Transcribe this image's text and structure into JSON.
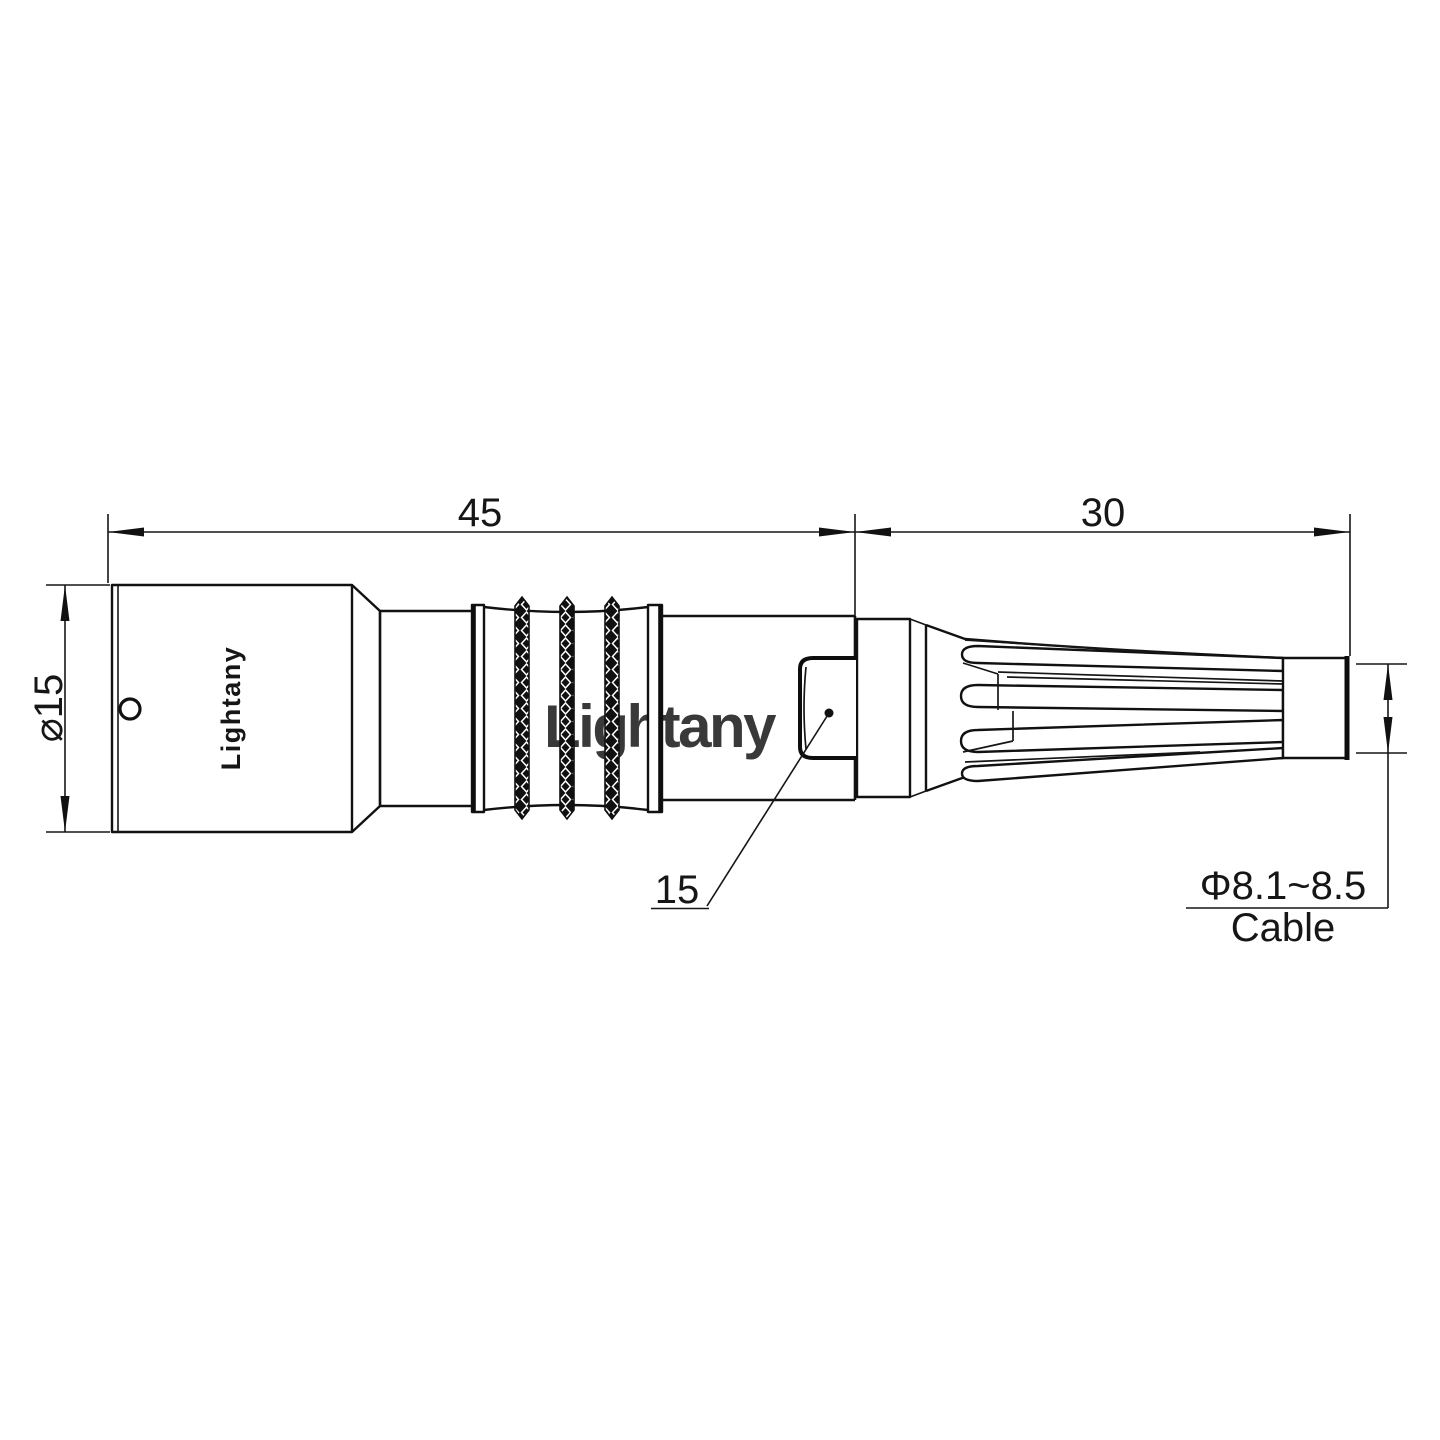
{
  "page": {
    "background": "#ffffff"
  },
  "drawing": {
    "type": "connector-technical-drawing",
    "engraving": {
      "brand": "Lightany"
    },
    "watermark": {
      "text": "Lightany",
      "color": "#f2c0ba"
    },
    "labels": {
      "overall_length": "45",
      "strain_relief_length": "30",
      "body_diameter": "⌀15",
      "leader_note": "15",
      "cable_diameter_range": "Φ8.1~8.5",
      "cable_caption": "Cable"
    },
    "colors": {
      "ink": "#111111",
      "background": "#ffffff"
    }
  }
}
